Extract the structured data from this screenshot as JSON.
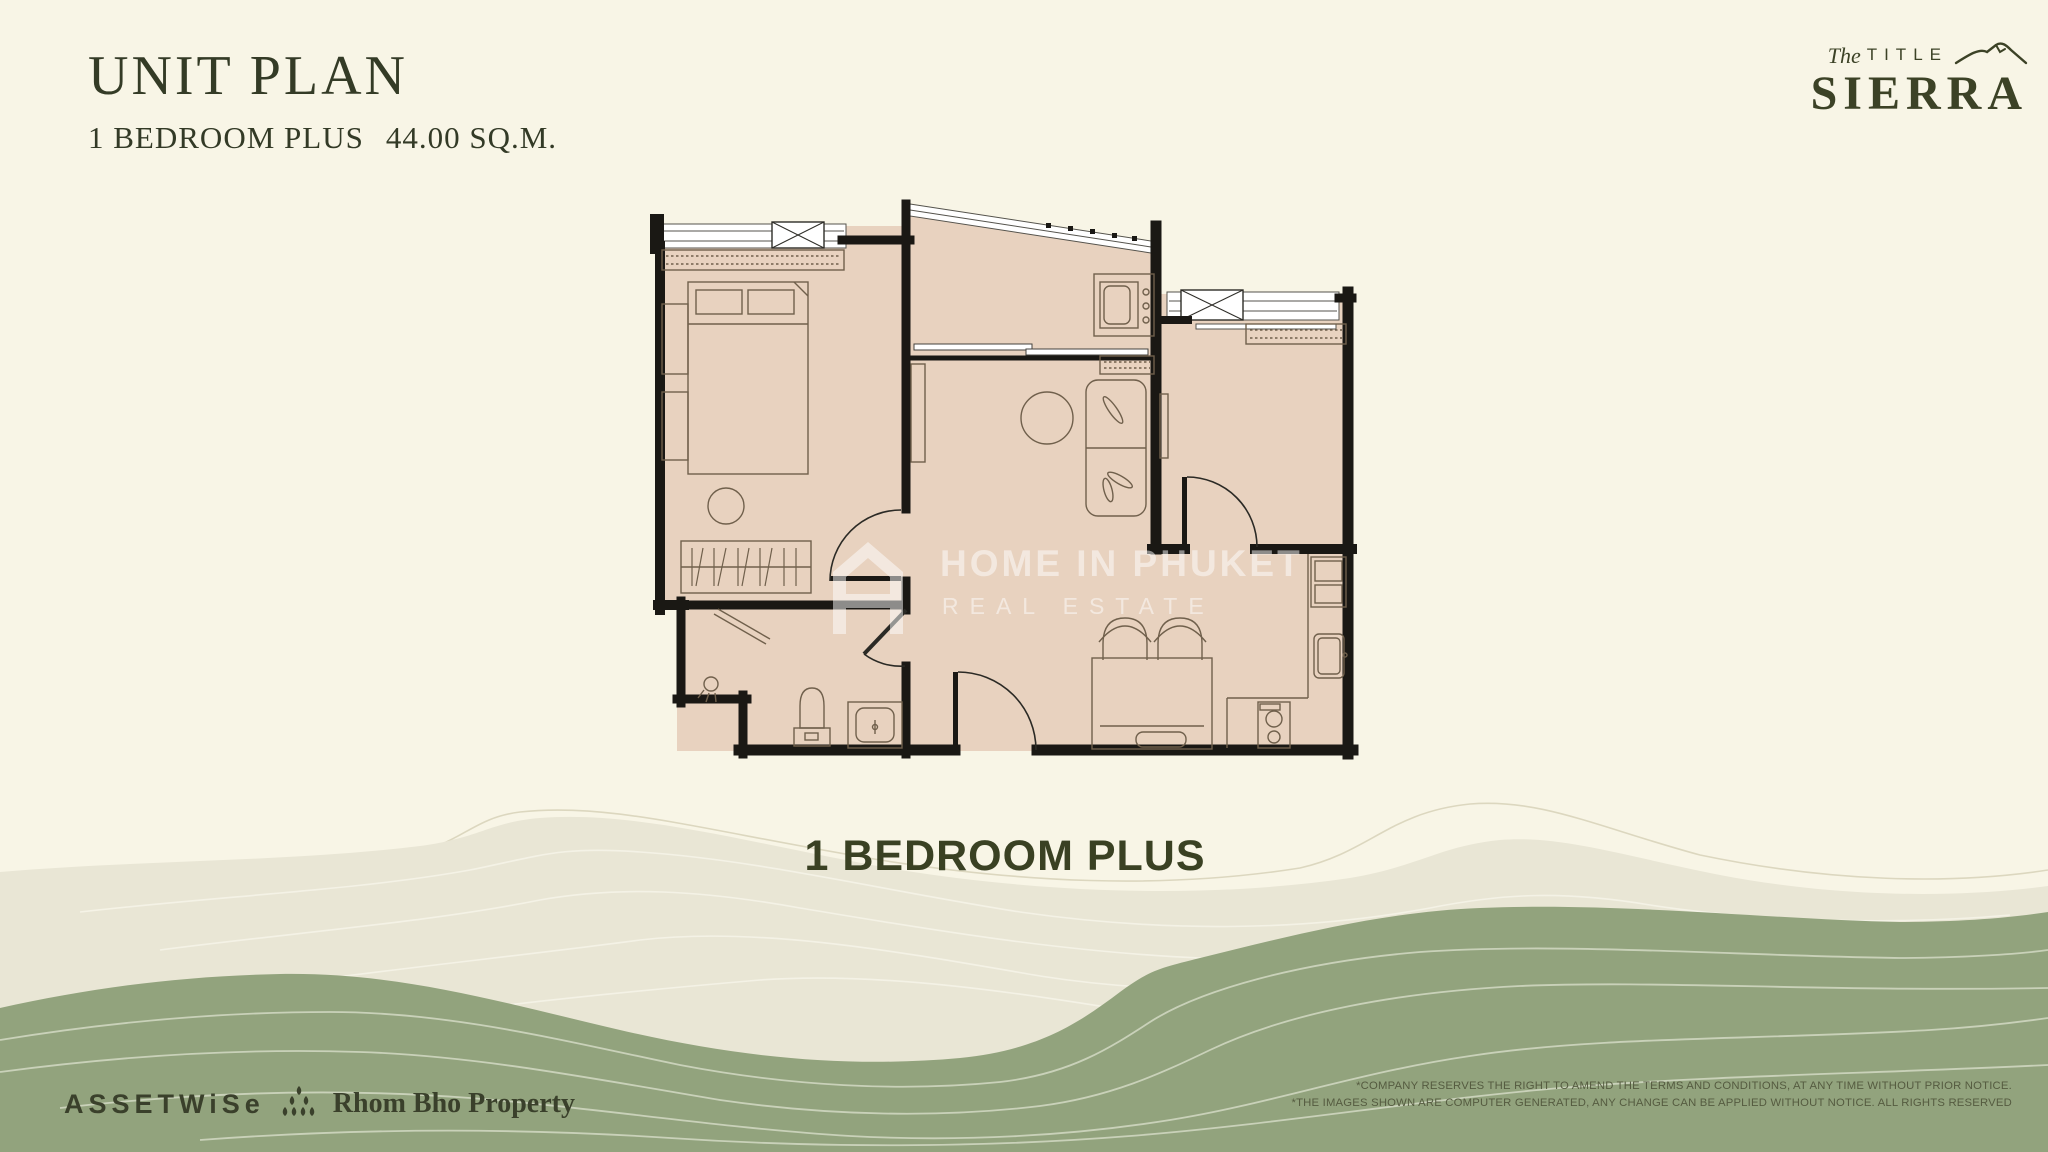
{
  "page": {
    "background": "#f8f5e6",
    "accent_green": "#353c26",
    "wave_green": "#92a37d",
    "wave_grey": "#e9e6d5"
  },
  "header": {
    "title": "UNIT PLAN",
    "unit_type": "1 BEDROOM PLUS",
    "area": "44.00 SQ.M."
  },
  "brand": {
    "pre": "The",
    "word": "TITLE",
    "name": "SIERRA"
  },
  "watermark": {
    "line1": "HOME IN PHUKET",
    "line2": "REAL ESTATE"
  },
  "plan": {
    "caption": "1 BEDROOM PLUS",
    "floor_color": "#e8d2bf",
    "wall_color": "#1a1814"
  },
  "footer": {
    "assetwise": "ASSETWiSe",
    "partner": "Rhom Bho Property",
    "disclaimer1": "*COMPANY RESERVES THE RIGHT TO AMEND THE TERMS AND CONDITIONS, AT ANY TIME WITHOUT PRIOR NOTICE.",
    "disclaimer2": "*THE IMAGES SHOWN ARE COMPUTER GENERATED, ANY CHANGE CAN BE APPLIED WITHOUT NOTICE. ALL RIGHTS RESERVED"
  }
}
